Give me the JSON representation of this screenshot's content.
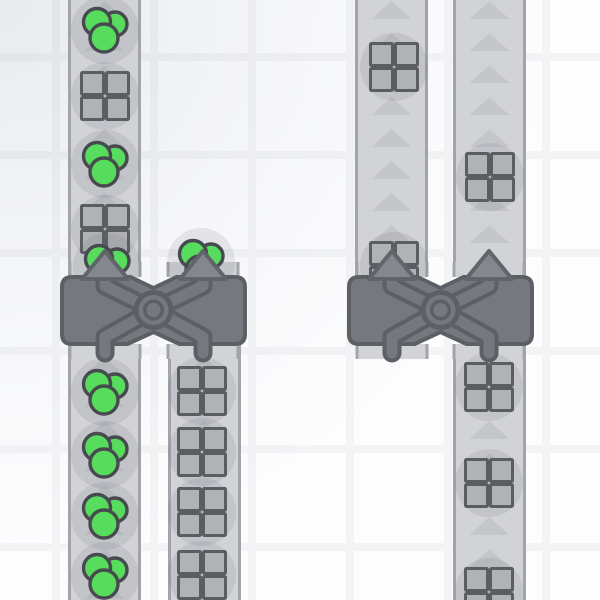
{
  "scene": {
    "game_style": "conveyor-factory",
    "viewport": {
      "width": 600,
      "height": 600
    },
    "background": {
      "base_color": "#fdfdfe",
      "tile_size": 98,
      "grid_offset_x": 52,
      "grid_offset_y": 53,
      "line_width": 8,
      "line_color": "#f3f4f6",
      "vignette_start": "rgba(122,136,155,0.16)",
      "vignette_mid": "rgba(122,136,155,0.05)",
      "vignette_end": "rgba(122,136,155,0)"
    },
    "colors": {
      "belt": "#d2d3d6",
      "belt_edge": "#a2a4aa",
      "belt_arrow": "#c5c6ca",
      "slot": "#d2d3d6",
      "item_shadow": "rgba(100,104,118,0.13)",
      "square_fill": "#b1b2b4",
      "square_stroke": "#5a5d61",
      "green_fill": "#58dc5e",
      "green_stroke": "#474a4e",
      "machine_fill": "#75797f",
      "machine_stroke": "#5c6065",
      "arrow_fill": "#84888e",
      "arrow_stroke": "#61656b"
    },
    "arrow_spacing": 32,
    "item_shadow_radius": 34,
    "belts": [
      {
        "x": 68,
        "y1": 0,
        "y2": 277,
        "width": 73,
        "arrow_start": 10
      },
      {
        "x": 68,
        "y1": 344,
        "y2": 600,
        "width": 73,
        "arrow_start": 366
      },
      {
        "x": 168,
        "y1": 344,
        "y2": 600,
        "width": 73,
        "arrow_start": 366
      },
      {
        "x": 355,
        "y1": 0,
        "y2": 277,
        "width": 73,
        "arrow_start": 10
      },
      {
        "x": 453,
        "y1": 0,
        "y2": 277,
        "width": 73,
        "arrow_start": 10
      },
      {
        "x": 453,
        "y1": 344,
        "y2": 600,
        "width": 73,
        "arrow_start": 366
      }
    ],
    "items": [
      {
        "type": "green",
        "x": 105,
        "y": 30
      },
      {
        "type": "square",
        "x": 105,
        "y": 96
      },
      {
        "type": "green",
        "x": 105,
        "y": 164
      },
      {
        "type": "square",
        "x": 105,
        "y": 229
      },
      {
        "type": "square",
        "x": 394,
        "y": 67
      },
      {
        "type": "square",
        "x": 490,
        "y": 177
      },
      {
        "type": "green",
        "x": 105,
        "y": 392
      },
      {
        "type": "green",
        "x": 105,
        "y": 455
      },
      {
        "type": "green",
        "x": 105,
        "y": 516
      },
      {
        "type": "green",
        "x": 105,
        "y": 576
      },
      {
        "type": "square",
        "x": 202,
        "y": 391
      },
      {
        "type": "square",
        "x": 202,
        "y": 452
      },
      {
        "type": "square",
        "x": 202,
        "y": 512
      },
      {
        "type": "square",
        "x": 202,
        "y": 575
      },
      {
        "type": "square",
        "x": 489,
        "y": 387
      },
      {
        "type": "square",
        "x": 489,
        "y": 483
      },
      {
        "type": "square",
        "x": 489,
        "y": 592
      }
    ],
    "stuck_items": [
      {
        "type": "green",
        "x": 107,
        "y": 267
      },
      {
        "type": "green",
        "x": 201,
        "y": 262
      },
      {
        "type": "square",
        "x": 394,
        "y": 266
      }
    ],
    "balancers": [
      {
        "x": 62,
        "y": 277,
        "width": 183,
        "height": 67,
        "lane_centers": [
          105,
          203
        ]
      },
      {
        "x": 349,
        "y": 277,
        "width": 183,
        "height": 67,
        "lane_centers": [
          392,
          489
        ]
      }
    ]
  }
}
